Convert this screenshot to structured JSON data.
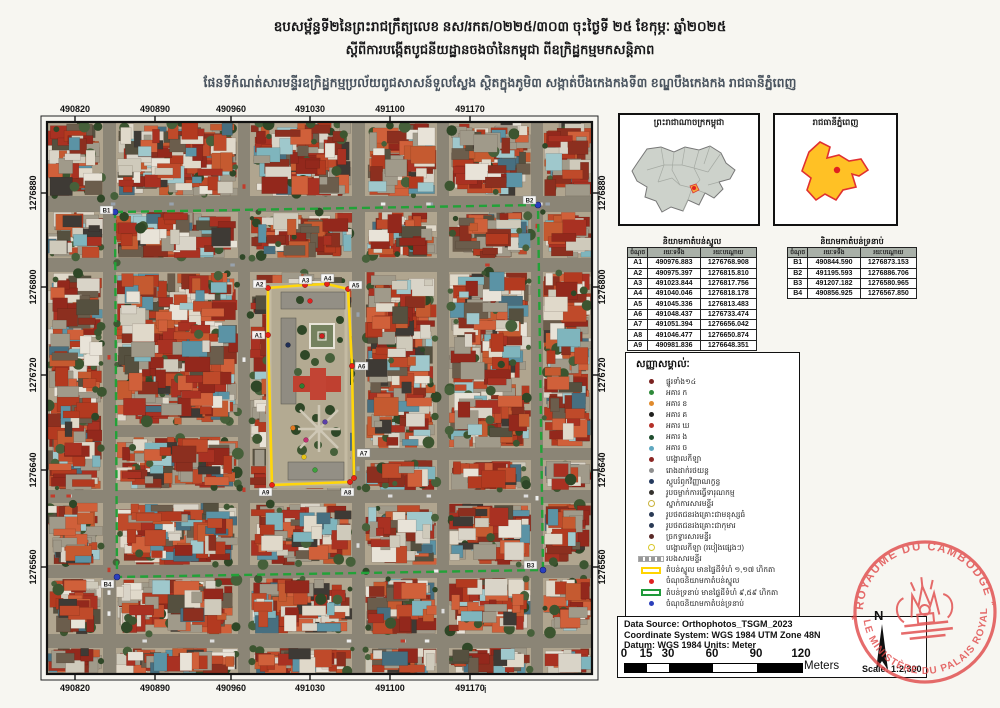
{
  "header": {
    "line1": "ឧបសម្ព័ន្ធទី២នៃព្រះរាជក្រឹត្យលេខ នស/រកត/០២២៥/៣០៣ ចុះថ្ងៃទី ២៥ ខែកុម្ភៈ ឆ្នាំ២០២៥",
    "line2": "ស្តីពីការបង្កើតបូជនីយដ្ឋានចងចាំនៃកម្ពុជា ពីឧក្រិដ្ឋកម្មមកសន្តិភាព",
    "line3": "ផែនទីកំណត់សារមន្ទីរឧក្រិដ្ឋកម្មប្រល័យពូជសាសន៍ទួលស្លែង ស្ថិតក្នុងភូមិ៣ សង្កាត់បឹងកេងកងទី៣ ខណ្ឌបឹងកេងកង រាជធានីភ្នំពេញ"
  },
  "map": {
    "x_ticks": [
      "490820",
      "490890",
      "490960",
      "491030",
      "491100",
      "491170"
    ],
    "y_ticks": [
      "1276880",
      "1276800",
      "1276720",
      "1276640",
      "1276560"
    ],
    "core_point_labels": [
      "A1",
      "A2",
      "A3",
      "A4",
      "A5",
      "A6",
      "A7",
      "A8",
      "A9"
    ],
    "buffer_point_labels": [
      "B1",
      "B2",
      "B3",
      "B4"
    ],
    "core_zone_color": "#ffd60a",
    "buffer_zone_color": "#22a238"
  },
  "insets": {
    "country": {
      "title": "ព្រះរាជាណាចក្រកម្ពុជា"
    },
    "capital": {
      "title": "រាជធានីភ្នំពេញ"
    }
  },
  "tables": {
    "core": {
      "title": "និយាមកាតំបន់ស្នូល",
      "headers": [
        "ចំណុច",
        "រយៈទទឹង",
        "រយៈបណ្ដោយ"
      ],
      "rows": [
        [
          "A1",
          "490976.883",
          "1276768.908"
        ],
        [
          "A2",
          "490975.397",
          "1276815.810"
        ],
        [
          "A3",
          "491023.844",
          "1276817.756"
        ],
        [
          "A4",
          "491040.046",
          "1276818.178"
        ],
        [
          "A5",
          "491045.336",
          "1276813.483"
        ],
        [
          "A6",
          "491048.437",
          "1276733.474"
        ],
        [
          "A7",
          "491051.394",
          "1276656.042"
        ],
        [
          "A8",
          "491046.477",
          "1276650.874"
        ],
        [
          "A9",
          "490981.836",
          "1276648.351"
        ]
      ]
    },
    "buffer": {
      "title": "និយាមកាតំបន់ទ្រនាប់",
      "headers": [
        "ចំណុច",
        "រយៈទទឹង",
        "រយៈបណ្ដោយ"
      ],
      "rows": [
        [
          "B1",
          "490844.590",
          "1276873.153"
        ],
        [
          "B2",
          "491195.593",
          "1276886.706"
        ],
        [
          "B3",
          "491207.182",
          "1276580.965"
        ],
        [
          "B4",
          "490856.925",
          "1276567.850"
        ]
      ]
    }
  },
  "legend": {
    "title": "សញ្ញាសម្គាល់ៈ",
    "items": [
      {
        "c": "#7a2220",
        "label": "ផ្នូរទាំង១៤"
      },
      {
        "c": "#2f8a3a",
        "label": "អគារ ក"
      },
      {
        "c": "#e08b2d",
        "label": "អគារ ខ"
      },
      {
        "c": "#20201e",
        "label": "អគារ គ"
      },
      {
        "c": "#b43028",
        "label": "អគារ ឃ"
      },
      {
        "c": "#1f4d2e",
        "label": "អគារ ង"
      },
      {
        "c": "#5fa8c0",
        "label": "អគារ ច"
      },
      {
        "c": "#8c2724",
        "label": "បង្គោលកីឡា"
      },
      {
        "c": "#8f8f8f",
        "label": "រោងដាក់រថយន្ត"
      },
      {
        "c": "#243a5e",
        "label": "ស្តូបរំឭកវិញ្ញាណក្ខន្ធ"
      },
      {
        "c": "#35332f",
        "label": "រូបចម្លាក់ការធ្វើទារុណកម្ម"
      },
      {
        "c": "#c9b23a",
        "hollow": true,
        "label": "ស្នាក់ការសារមន្ទីរ"
      },
      {
        "c": "#2a3a55",
        "label": "រូបថតជនរងគ្រោះជាមនុស្សធំ"
      },
      {
        "c": "#2a3a55",
        "label": "រូបថតជនរងគ្រោះជាកុមារ"
      },
      {
        "c": "#5a2a28",
        "label": "ច្រកទ្វារសារមន្ទីរ"
      },
      {
        "c": "#d8c728",
        "hollow": true,
        "label": "បង្គោលកីឡា (របៀងផ្សេងៗ)"
      },
      {
        "type": "hatch",
        "c": "#9a9a9a",
        "label": "របងសារមន្ទីរ"
      }
    ],
    "zones": [
      {
        "type": "rect",
        "c": "#ffd400",
        "label": "តំបន់ស្នូល មានផ្ទៃដីទំហំ ១,១៧ ហិកតា"
      },
      {
        "type": "dot",
        "c": "#e02020",
        "label": "ចំណុចនិយាមកាតំបន់ស្នូល"
      },
      {
        "type": "rect",
        "c": "#1f9a3a",
        "label": "តំបន់ទ្រនាប់ មានផ្ទៃដីទំហំ ៩,៥៩ ហិកតា"
      },
      {
        "type": "dot",
        "c": "#2b3fbb",
        "label": "ចំណុចនិយាមកាតំបន់ទ្រនាប់"
      }
    ]
  },
  "info": {
    "lines": [
      "Data Source: Orthophotos_TSGM_2023",
      "Coordinate System: WGS 1984 UTM Zone 48N",
      "Datum: WGS 1984 Units: Meter"
    ],
    "scalebar": {
      "ticks": [
        "0",
        "15",
        "30",
        "60",
        "90",
        "120"
      ],
      "unit": "Meters"
    },
    "scale_text": "Scale: 1:2,300",
    "north_label": "N"
  },
  "stamp": {
    "top": "ROYAUME DU CAMBODGE",
    "bottom": "LE MINISTÈRE DU PALAIS ROYAL",
    "color": "#e04848"
  },
  "footer": {
    "page": "i"
  }
}
